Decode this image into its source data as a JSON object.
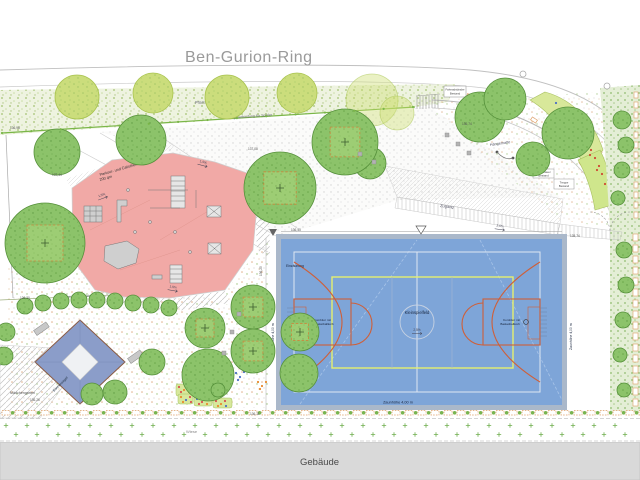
{
  "street": {
    "name": "Ben-Gurion-Ring"
  },
  "building": {
    "label": "Gebäude"
  },
  "labels": {
    "planting_existing": "Pflanzung Bestand",
    "players_path": "Wegeverbindung für Spieler",
    "crossing": "Überquerung für Spieler",
    "bike_rack_1": "Fahrradständer",
    "bike_rack_2": "Bestand",
    "parkour_1": "Parkour- und Calisthenics-Bereich",
    "parkour_2": "200 qm",
    "court_center": "Kleinspielfeld",
    "goal_left_1": "Kombitor mit",
    "goal_left_2": "Basketballkorb",
    "goal_right_1": "Kombitor mit",
    "goal_right_2": "Basketballkorb",
    "fence_bottom": "Zaunhöhe 4,00 m",
    "fence_left": "Zaunhöhe 4,00 m",
    "fence_right": "Zaunhöhe 4,00 m",
    "enclosure": "Einzäunung",
    "access": "Zugang",
    "lawn": "Wiese",
    "hammock": "Hängematte",
    "girls_garden": "Mädchengarten",
    "sun_sail": "Sonnensegel",
    "wall_note_1": "Stützmauer",
    "wall_note_2": "Bestand",
    "stairs_note_1": "Treppe",
    "stairs_note_2": "Bestand"
  },
  "annotations": {
    "slopes": [
      "2,5%",
      "2,5%",
      "1,5%",
      "1,5%",
      "1,5%"
    ],
    "elevations": [
      "136,98",
      "137,44",
      "137,08",
      "136,43",
      "136,26",
      "136,74",
      "135,74",
      "136,25",
      "136,30",
      "136,11"
    ]
  },
  "colors": {
    "court_blue": "#7ea5d8",
    "court_marking": "#cf5f38",
    "field_yellow": "#e5ef6e",
    "parkour_red": "#f1a9a6",
    "tree_green": "#8cc36a",
    "canopy_blue": "#8b9dc9",
    "building_gray": "#d9d9d9"
  }
}
